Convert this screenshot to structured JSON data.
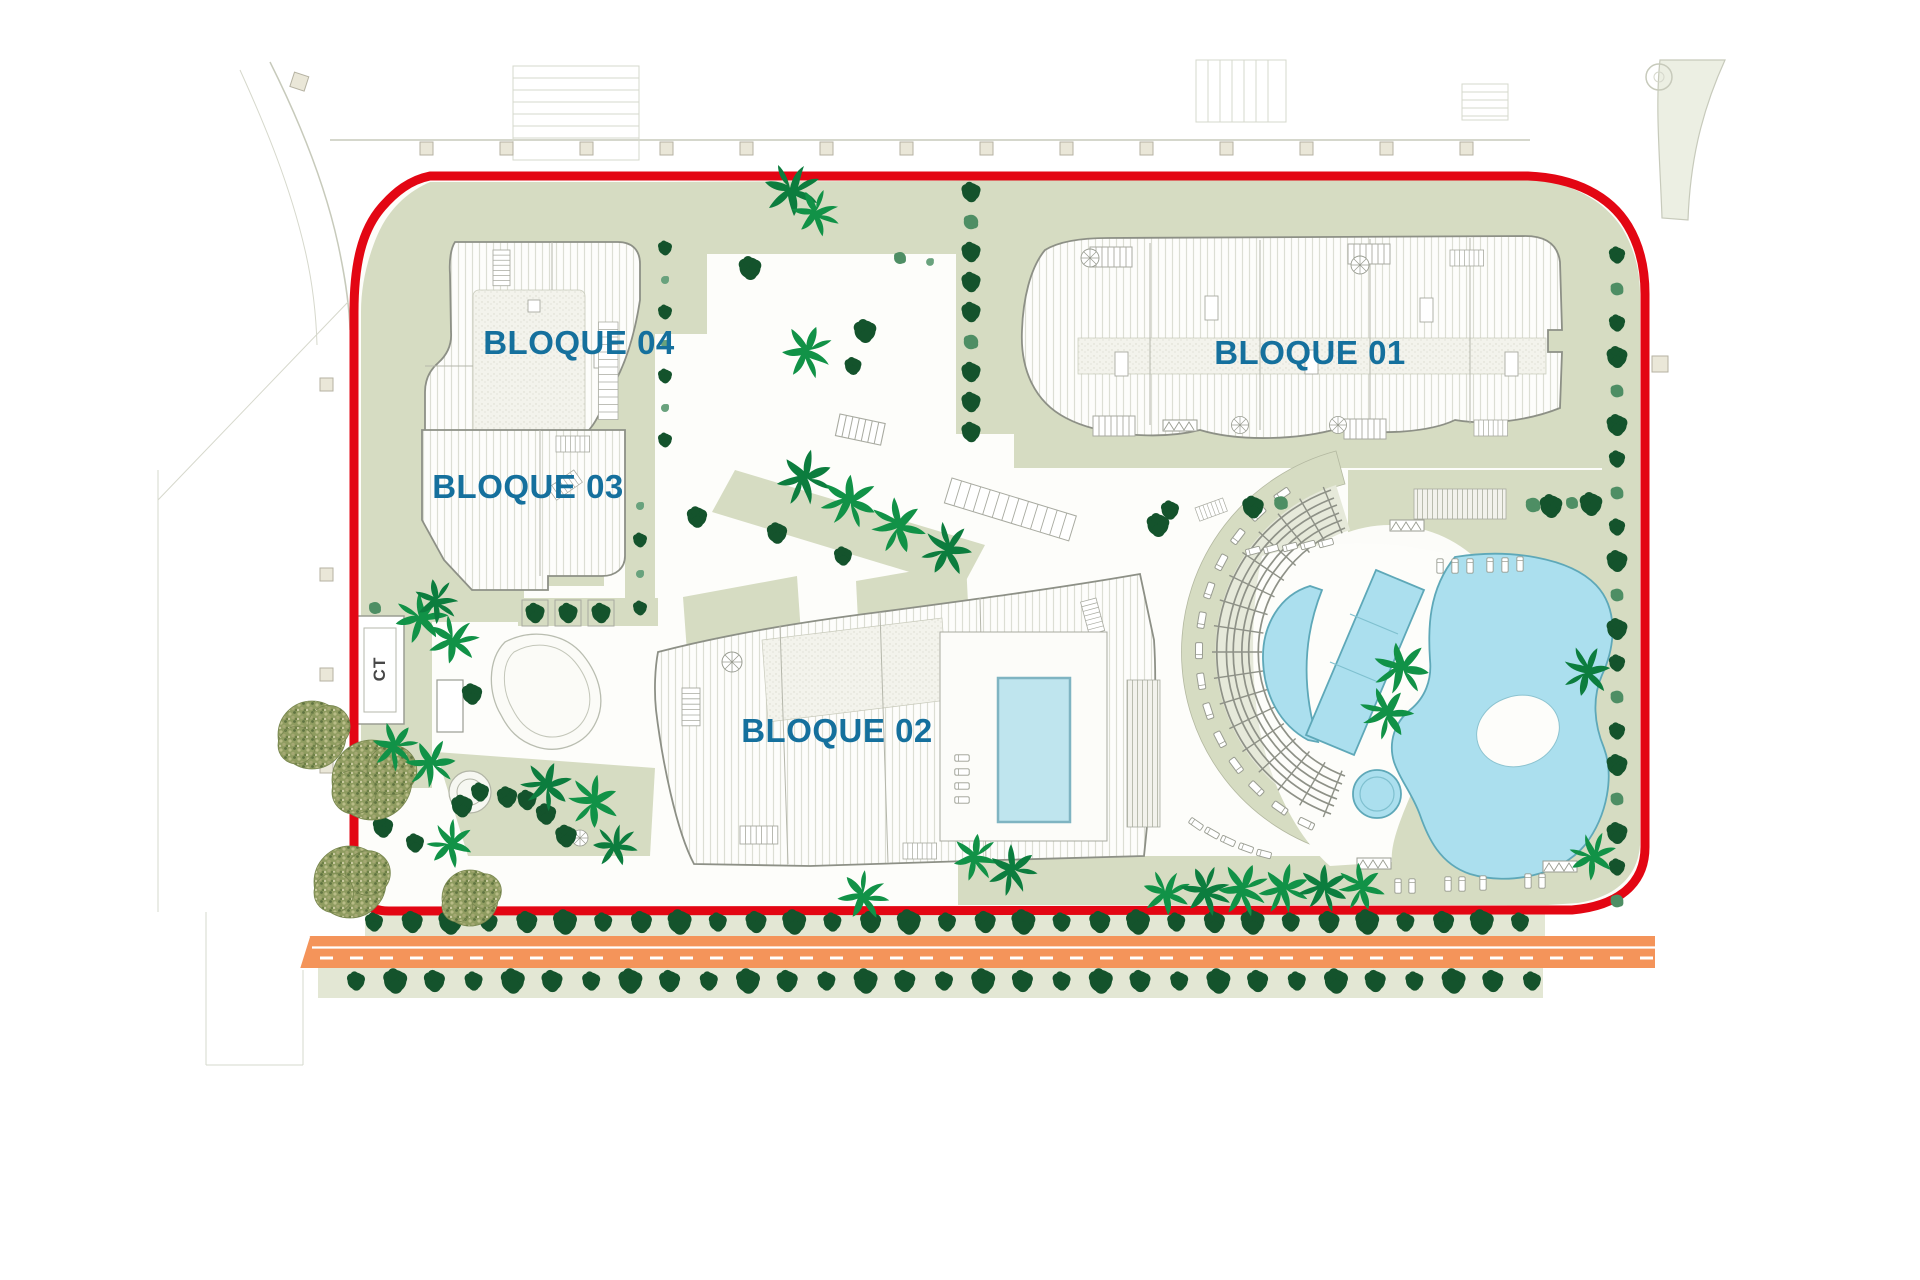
{
  "site_plan": {
    "block_labels": {
      "bloque_01": "BLOQUE 01",
      "bloque_02": "BLOQUE 02",
      "bloque_03": "BLOQUE 03",
      "bloque_04": "BLOQUE 04"
    },
    "utility_label": "CT",
    "colors": {
      "boundary_red": "#e30613",
      "label_blue": "#15709d",
      "road_orange": "#f4945a",
      "pool_water": "#abdfee",
      "landscape_sage": "#d6dcc2",
      "tree_dark_green": "#14532c",
      "palm_green": "#119247"
    }
  }
}
